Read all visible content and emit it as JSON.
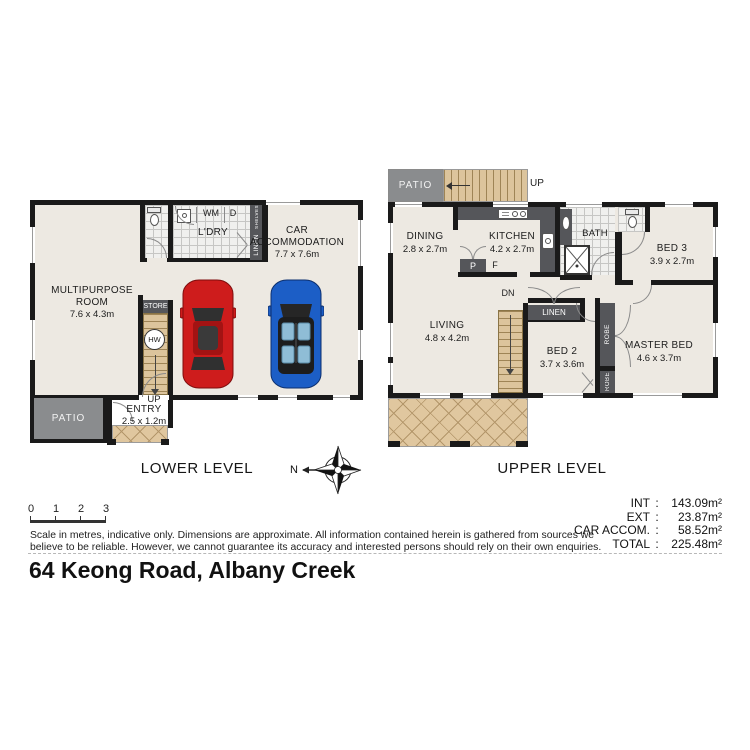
{
  "address": "64 Keong Road, Albany Creek",
  "levels": {
    "lower_title": "LOWER LEVEL",
    "upper_title": "UPPER LEVEL"
  },
  "compass": {
    "north_label": "N"
  },
  "scale_bar": {
    "ticks": [
      "0",
      "1",
      "2",
      "3"
    ]
  },
  "disclaimer": {
    "line1": "Scale in metres, indicative only. Dimensions are approximate. All information contained herein is gathered from sources we",
    "line2": "believe to be reliable. However, we cannot guarantee its accuracy and interested persons should rely on their own enquiries."
  },
  "areas": {
    "colon": ":",
    "rows": [
      {
        "label": "INT",
        "value": "143.09m²"
      },
      {
        "label": "EXT",
        "value": "23.87m²"
      },
      {
        "label": "CAR ACCOM.",
        "value": "58.52m²"
      },
      {
        "label": "TOTAL",
        "value": "225.48m²"
      }
    ]
  },
  "lower": {
    "multipurpose_line1": "MULTIPURPOSE",
    "multipurpose_line2": "ROOM",
    "multipurpose_dims": "7.6 x 4.3m",
    "car_line1": "CAR",
    "car_line2": "ACCOMMODATION",
    "car_dims": "7.7 x 7.6m",
    "laundry": "L'DRY",
    "wm": "WM",
    "d": "D",
    "shelves": "SHELVES",
    "linen": "LINEN",
    "store": "STORE",
    "hw": "HW",
    "up": "UP",
    "entry": "ENTRY",
    "entry_dims": "2.5 x 1.2m",
    "patio": "PATIO"
  },
  "upper": {
    "patio": "PATIO",
    "up": "UP",
    "dn": "DN",
    "dining": "DINING",
    "dining_dims": "2.8 x 2.7m",
    "kitchen": "KITCHEN",
    "kitchen_dims": "4.2 x 2.7m",
    "pantry": "P",
    "fridge": "F",
    "bath": "BATH",
    "bed3": "BED 3",
    "bed3_dims": "3.9 x 2.7m",
    "living": "LIVING",
    "living_dims": "4.8 x 4.2m",
    "linen": "LINEN",
    "bed2": "BED 2",
    "bed2_dims": "3.7 x 3.6m",
    "robe1": "ROBE",
    "robe2": "ROBE",
    "master": "MASTER BED",
    "master_dims": "4.6 x 3.7m"
  }
}
